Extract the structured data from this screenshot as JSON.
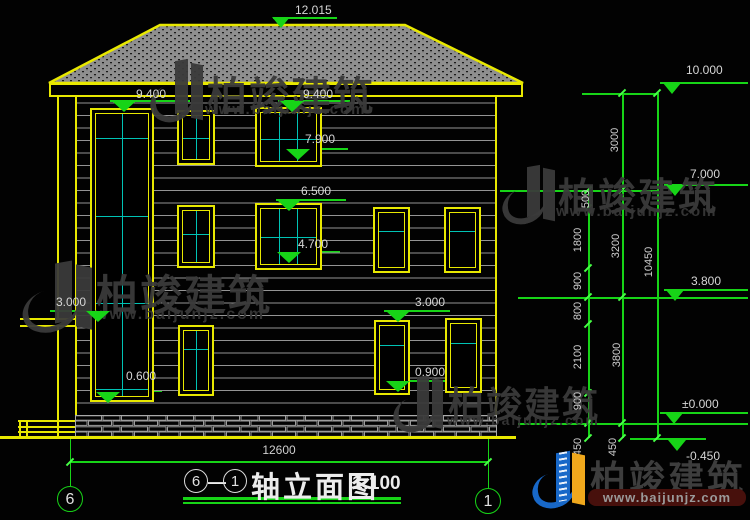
{
  "levels": {
    "ridge": "12.015",
    "eave_left": "9.400",
    "eave_right": "9.400",
    "win3_sill": "7.900",
    "win2_head": "6.500",
    "win2_sill": "4.700",
    "canopy": "3.000",
    "stair_sill": "0.600",
    "win1_head": "3.000",
    "win1_sill": "0.900",
    "right": [
      "10.000",
      "7.000",
      "3.800",
      "±0.000",
      "-0.450"
    ]
  },
  "dims": {
    "chain_inner": [
      "500",
      "1800",
      "900",
      "800",
      "2100",
      "900",
      "450"
    ],
    "chain_outer": [
      "3000",
      "3200",
      "3800",
      "450"
    ],
    "total_height": "10450",
    "total_width": "12600"
  },
  "axes": {
    "left": "6",
    "right": "1"
  },
  "title": {
    "bubble_start": "6",
    "dash": "—",
    "bubble_end": "1",
    "text": "轴立面图",
    "scale": "1:100"
  },
  "watermark": {
    "brand": "柏竣建筑",
    "site": "www.baijunjz.com"
  },
  "logo": {
    "brand": "柏竣建筑",
    "site": "www.baijunjz.com"
  }
}
